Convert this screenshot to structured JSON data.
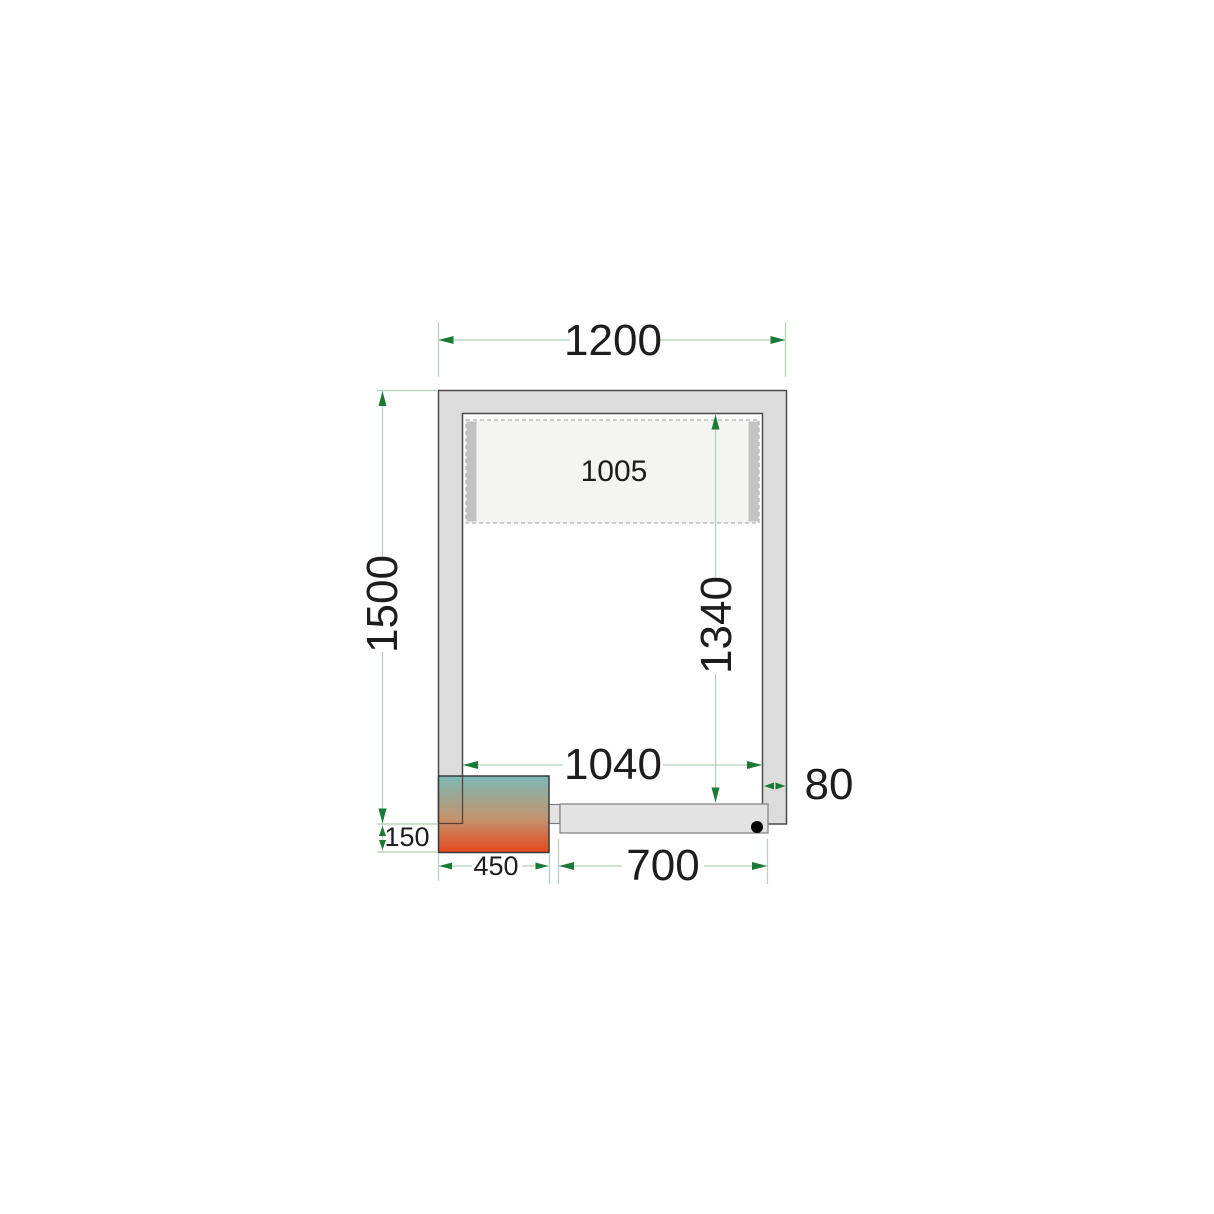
{
  "diagram": {
    "type": "cold-room-floor-plan",
    "labels": {
      "outer_width": "1200",
      "outer_height": "1500",
      "panel_width": "1005",
      "inner_height": "1340",
      "inner_width": "1040",
      "wall_thickness": "80",
      "unit_protrusion": "150",
      "unit_width": "450",
      "door_width": "700"
    },
    "colors": {
      "dimension_arrow": "#1b7a36",
      "dimension_line": "#b5cfb8",
      "wall_fill": "#dcdcdc",
      "wall_outline": "#4a4a4a",
      "panel_fill": "#f4f4f2",
      "panel_border": "#b0b0b0",
      "panel_bar": "#c3c3c3",
      "door_fill": "#e3e3e3",
      "door_outline": "#7f7f7f",
      "handle_dot": "#000000",
      "unit_gradient_top": "#7cb9b6",
      "unit_gradient_mid": "#c1946f",
      "unit_gradient_bottom": "#e8481c",
      "unit_outline": "#3a3a3a",
      "text": "#1d1d1d"
    }
  }
}
